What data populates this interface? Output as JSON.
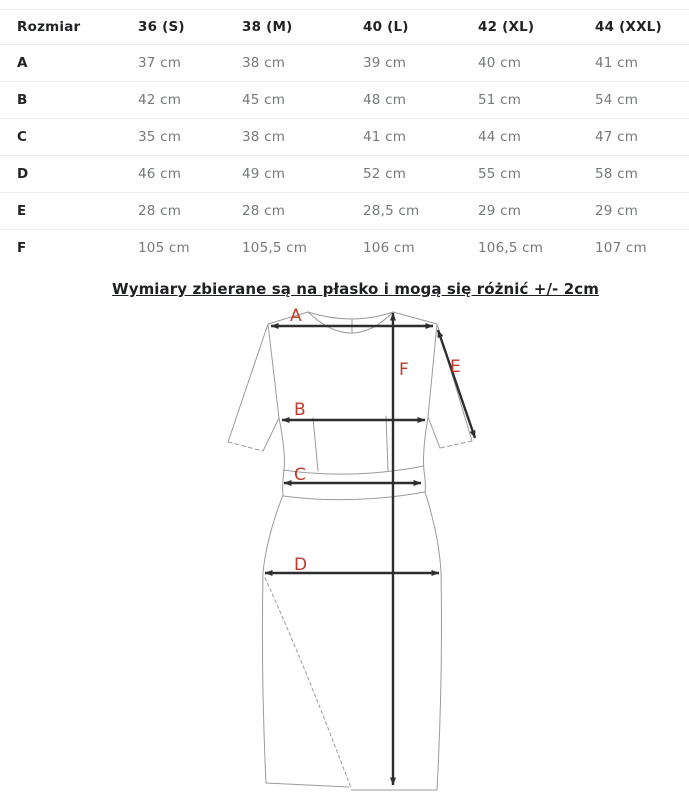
{
  "table": {
    "header": [
      "Rozmiar",
      "36 (S)",
      "38 (M)",
      "40 (L)",
      "42 (XL)",
      "44 (XXL)"
    ],
    "rows": [
      {
        "label": "A",
        "values": [
          "37 cm",
          "38 cm",
          "39 cm",
          "40 cm",
          "41 cm"
        ]
      },
      {
        "label": "B",
        "values": [
          "42 cm",
          "45 cm",
          "48 cm",
          "51 cm",
          "54 cm"
        ]
      },
      {
        "label": "C",
        "values": [
          "35 cm",
          "38 cm",
          "41 cm",
          "44 cm",
          "47 cm"
        ]
      },
      {
        "label": "D",
        "values": [
          "46 cm",
          "49 cm",
          "52 cm",
          "55 cm",
          "58 cm"
        ]
      },
      {
        "label": "E",
        "values": [
          "28 cm",
          "28 cm",
          "28,5 cm",
          "29 cm",
          "29 cm"
        ]
      },
      {
        "label": "F",
        "values": [
          "105 cm",
          "105,5 cm",
          "106 cm",
          "106,5 cm",
          "107 cm"
        ]
      }
    ]
  },
  "caption": "Wymiary zbierane są na płasko i mogą się różnić +/- 2cm",
  "diagram": {
    "label_color": "#c0392b",
    "outline_color": "#9b9b9b",
    "arrow_color": "#2e2e2e",
    "labels": {
      "A": "A",
      "B": "B",
      "C": "C",
      "D": "D",
      "E": "E",
      "F": "F"
    }
  }
}
